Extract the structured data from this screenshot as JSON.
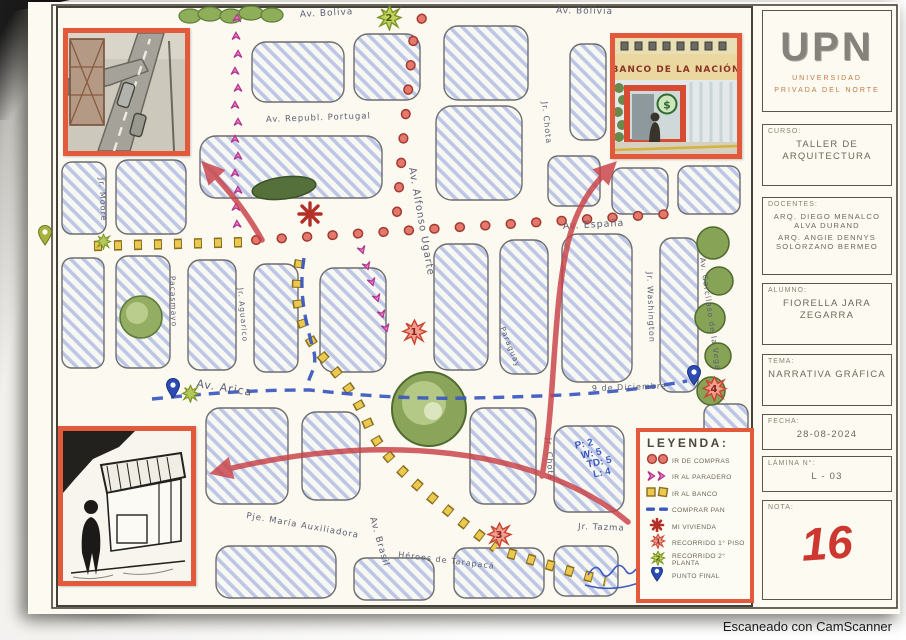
{
  "scan": {
    "watermark": "Escaneado con CamScanner"
  },
  "title_block": {
    "logo": "UPN",
    "university_line1": "UNIVERSIDAD",
    "university_line2": "PRIVADA DEL NORTE",
    "curso_label": "CURSO:",
    "curso": "TALLER DE ARQUITECTURA",
    "docentes_label": "DOCENTES:",
    "docente1": "ARQ. DIEGO MENALCO ALVA DURAND",
    "docente2": "ARQ. ANGIE DENNYS SOLÓRZANO BERMEO",
    "alumno_label": "ALUMNO:",
    "alumno": "FIORELLA JARA ZEGARRA",
    "tema_label": "TEMA:",
    "tema": "NARRATIVA GRÁFICA",
    "fecha_label": "FECHA:",
    "fecha": "28-08-2024",
    "lamina_label": "LÁMINA N°:",
    "lamina": "L - 03",
    "nota_label": "NOTA:",
    "nota": "16"
  },
  "legend": {
    "title": "LEYENDA:",
    "items": [
      {
        "icon": "red-dots",
        "label": "IR DE COMPRAS"
      },
      {
        "icon": "pink-chevrons",
        "label": "IR AL PARADERO"
      },
      {
        "icon": "yellow-squares",
        "label": "IR AL BANCO"
      },
      {
        "icon": "blue-dashes",
        "label": "COMPRAR PAN"
      },
      {
        "icon": "red-asterisk",
        "label": "MI VIVIENDA"
      },
      {
        "icon": "red-splat",
        "label": "RECORRIDO 1° PISO",
        "badge": "1"
      },
      {
        "icon": "green-splat",
        "label": "RECORRIDO 2° PLANTA",
        "badge": "2"
      },
      {
        "icon": "blue-pin",
        "label": "PUNTO FINAL"
      }
    ]
  },
  "streets": {
    "bolivia_left": "Av. Boliva",
    "bolivia_right": "Av. Bolivia",
    "portugal": "Av. Republ. Portugal",
    "espana": "Av. España",
    "ugarte": "Av. Alfonso Ugarte",
    "chota_top": "Jr. Chota",
    "moore": "Jr. Moore",
    "pacasmayo": "Pacasmayo",
    "aguarico": "Jr. Aguarico",
    "arica": "Av. Arica",
    "nueve_diciembre": "9 de Diciembre",
    "paraguay": "Paraguay",
    "washington": "Jr. Washington",
    "garcilaso": "Av. Garcilaso de la Vega",
    "maria_auxiliadora": "Pje. María Auxiliadora",
    "brasil": "Av. Brasil",
    "heroes": "Héroes de Tarapacá",
    "tazma": "Jr. Tazma",
    "chota_bottom": "Jr. Chota"
  },
  "markers": {
    "m1": "1",
    "m2": "2",
    "m3": "3",
    "m4": "4"
  },
  "insets": {
    "banco_sign": "BANCO DE LA NACIÓN",
    "banco_badge": "$"
  },
  "notes": {
    "grading": [
      "P: 2",
      "W: 5",
      "TD: 5",
      "L: 4"
    ]
  },
  "colors": {
    "accent_border": "#e2593c",
    "nota_red": "#cc3830",
    "route_blue": "#3a57c0",
    "route_pink": "#d553a8",
    "route_yellow": "#eac94e",
    "route_red": "#dd7066",
    "hatch_blue": "#b3bfe3"
  }
}
